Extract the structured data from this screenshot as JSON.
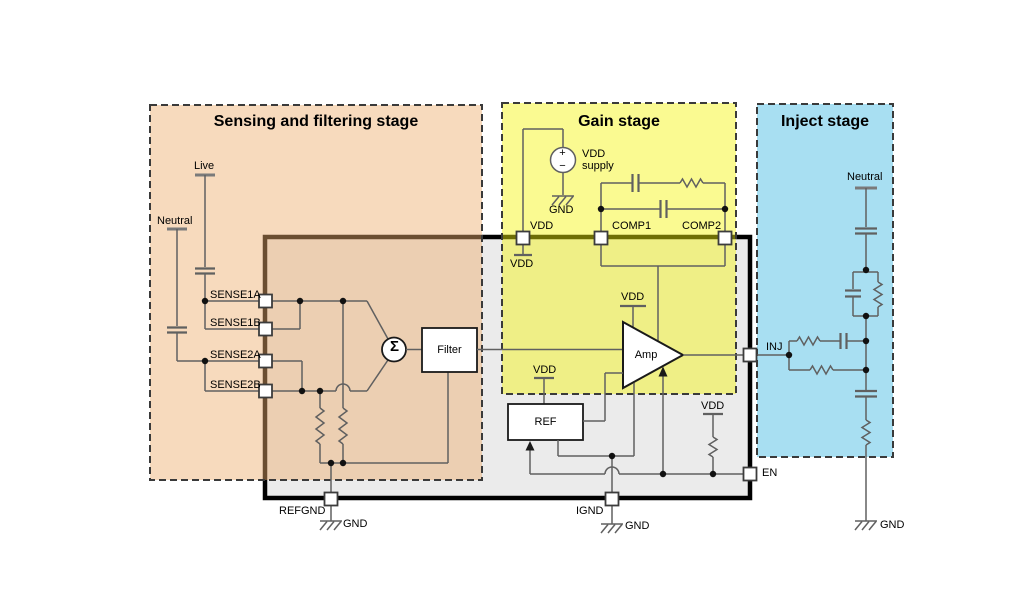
{
  "stages": {
    "sensing": {
      "title": "Sensing and filtering stage",
      "fill": "#F6D6B6"
    },
    "gain": {
      "title": "Gain stage",
      "fill": "#F7F77E"
    },
    "inject": {
      "title": "Inject stage",
      "fill": "#A8DFF2"
    }
  },
  "ic": {
    "fill": "#EBEBEB",
    "border": "#111111",
    "wire_color": "#606060"
  },
  "pins": {
    "sense1a": "SENSE1A",
    "sense1b": "SENSE1B",
    "sense2a": "SENSE2A",
    "sense2b": "SENSE2B",
    "vdd": "VDD",
    "comp1": "COMP1",
    "comp2": "COMP2",
    "inj": "INJ",
    "en": "EN",
    "refgnd": "REFGND",
    "ignd": "IGND"
  },
  "blocks": {
    "filter": "Filter",
    "amp": "Amp",
    "ref": "REF",
    "sum": "Σ"
  },
  "nets": {
    "live": "Live",
    "neutral_sense": "Neutral",
    "neutral_inject": "Neutral"
  },
  "supply": {
    "plus": "+",
    "minus": "−",
    "line1": "VDD",
    "line2": "supply",
    "gnd": "GND"
  },
  "vdd_stubs": {
    "pin": "VDD",
    "amp": "VDD",
    "ref": "VDD",
    "en": "VDD"
  },
  "grounds": {
    "refgnd": "GND",
    "ignd": "GND",
    "inject": "GND"
  }
}
